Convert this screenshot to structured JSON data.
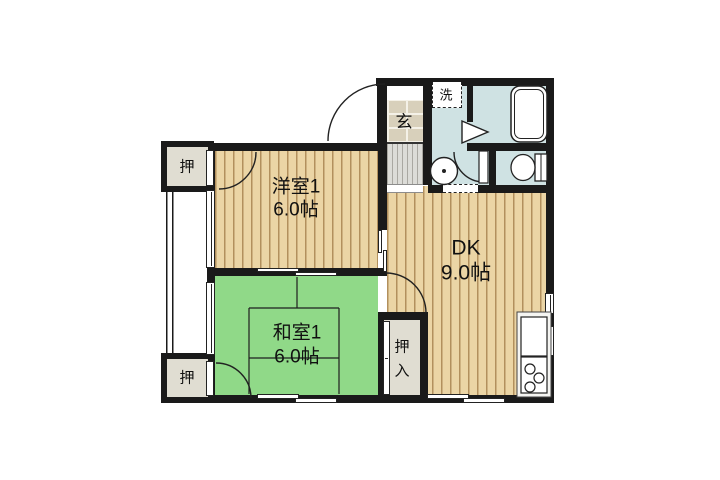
{
  "plan": {
    "rooms": [
      {
        "name": "western-room",
        "label": "洋室1",
        "size": "6.0帖"
      },
      {
        "name": "dining-kitchen",
        "label": "DK",
        "size": "9.0帖"
      },
      {
        "name": "japanese-room",
        "label": "和室1",
        "size": "6.0帖"
      }
    ],
    "labels": {
      "entrance": "玄",
      "washer": "洗",
      "closet_top": "押",
      "closet_bottom": "押",
      "oshiire": [
        "押",
        "入"
      ]
    },
    "colors": {
      "wall": "#1a1a1a",
      "wood": "#ebd5a5",
      "wood_line": "#b2905d",
      "tatami": "#90d988",
      "water": "#cfe2e3",
      "tile": "#d8d0bb",
      "closet": "#e0ddd2",
      "hall": "#dcdcd8"
    }
  }
}
